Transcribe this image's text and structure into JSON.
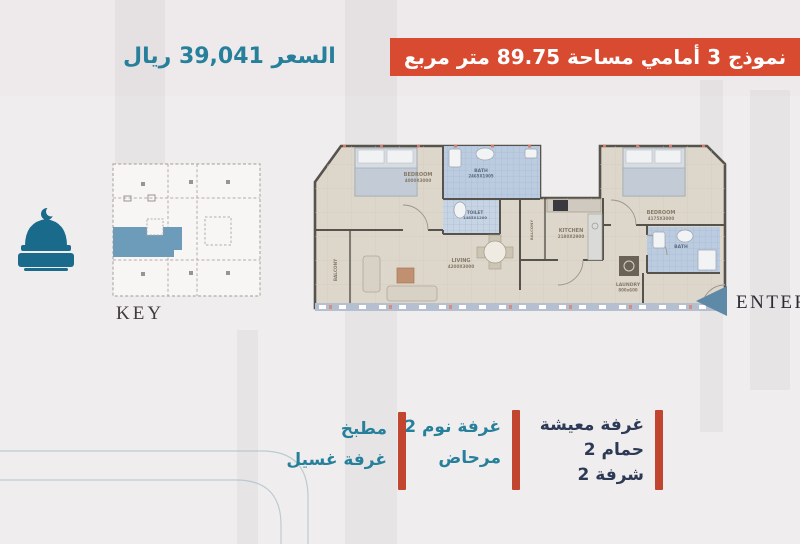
{
  "header": {
    "banner_text": "نموذج 3 أمامي مساحة 89.75 متر مربع",
    "banner_color": "#d84b31",
    "price_text": "السعر 39,041 ريال",
    "price_color": "#27809b"
  },
  "key_map": {
    "label": "KEY",
    "highlight_color": "#6d9cbb"
  },
  "mosque_icon_color": "#1a6a8c",
  "floor_plan": {
    "enter_label": "ENTER",
    "rooms": [
      {
        "label": "BEDROOM",
        "dims": "4000X3000"
      },
      {
        "label": "BATH",
        "dims": "2465X1905"
      },
      {
        "label": "TOILET",
        "dims": "1485X1200"
      },
      {
        "label": "BALCONY",
        "dims": ""
      },
      {
        "label": "LIVING",
        "dims": "4200X3000"
      },
      {
        "label": "BALCONY",
        "dims": ""
      },
      {
        "label": "KITCHEN",
        "dims": "2180X2900"
      },
      {
        "label": "BEDROOM",
        "dims": "4175X3000"
      },
      {
        "label": "BATH",
        "dims": ""
      },
      {
        "label": "LAUNDRY",
        "dims": "800x600"
      }
    ]
  },
  "legend": {
    "bar_color": "#c1452f",
    "columns": [
      {
        "color": "#2d3a56",
        "items": [
          "غرفة معيشة",
          "حمام 2",
          "شرفة 2"
        ]
      },
      {
        "color": "#27809b",
        "items": [
          "غرفة نوم 2",
          "مرحاض"
        ]
      },
      {
        "color": "#27809b",
        "items": [
          "مطبخ",
          "غرفة غسيل"
        ]
      }
    ]
  }
}
